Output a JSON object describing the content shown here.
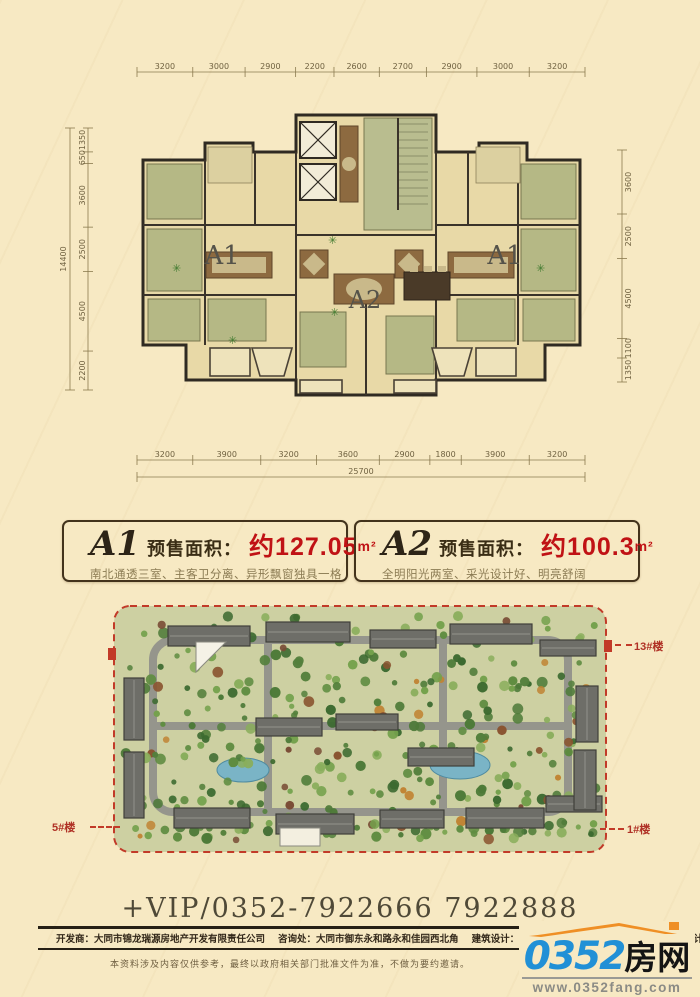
{
  "colors": {
    "page_bg": "#f7e9c3",
    "red": "#c01215",
    "dim_line": "#8a7a4f",
    "site_border_red": "#c23a28",
    "logo_blue": "#2190d6",
    "logo_orange": "#ef8f25"
  },
  "floorplan": {
    "dims_top": [
      3200,
      3000,
      2900,
      2200,
      2600,
      2700,
      2900,
      3000,
      3200
    ],
    "dims_bottom": [
      3200,
      3900,
      3200,
      3600,
      2900,
      1800,
      3900,
      3200
    ],
    "total_bottom": 25700,
    "dims_left": [
      1350,
      650,
      3600,
      2500,
      4500,
      2200
    ],
    "total_left": 14400,
    "dims_right": [
      3600,
      2500,
      4500,
      1100,
      1350
    ],
    "unit_labels": [
      "A1",
      "A2",
      "A1"
    ]
  },
  "units": [
    {
      "name": "A1",
      "field": "预售面积：",
      "area": "约127.05",
      "sup": "m²",
      "desc": "南北通透三室、主客卫分离、异形飘窗独具一格"
    },
    {
      "name": "A2",
      "field": "预售面积：",
      "area": "约100.3",
      "sup": "m²",
      "desc": "全明阳光两室、采光设计好、明亮舒阔"
    }
  ],
  "siteplan": {
    "label_13": "13#楼",
    "label_5": "5#楼",
    "label_1": "1#楼"
  },
  "phone": "+VIP/0352-7922666  7922888",
  "footer": {
    "items": [
      {
        "label": "开发商：",
        "value": "大同市锦龙瑞源房地产开发有限责任公司"
      },
      {
        "label": "咨询处：",
        "value": "大同市御东永和路永和佳园西北角"
      },
      {
        "label": "建筑设计：",
        "value": "北京恩影空间"
      },
      {
        "label": "园林设计：",
        "value": "北京…景观设计有限责任公司"
      }
    ],
    "disclaimer": "本资料涉及内容仅供参考，最终以政府相关部门批准文件为准，不做为要约邀请。"
  },
  "logo": {
    "num": "0352",
    "cn": "房网",
    "site": "www.0352fang.com"
  }
}
